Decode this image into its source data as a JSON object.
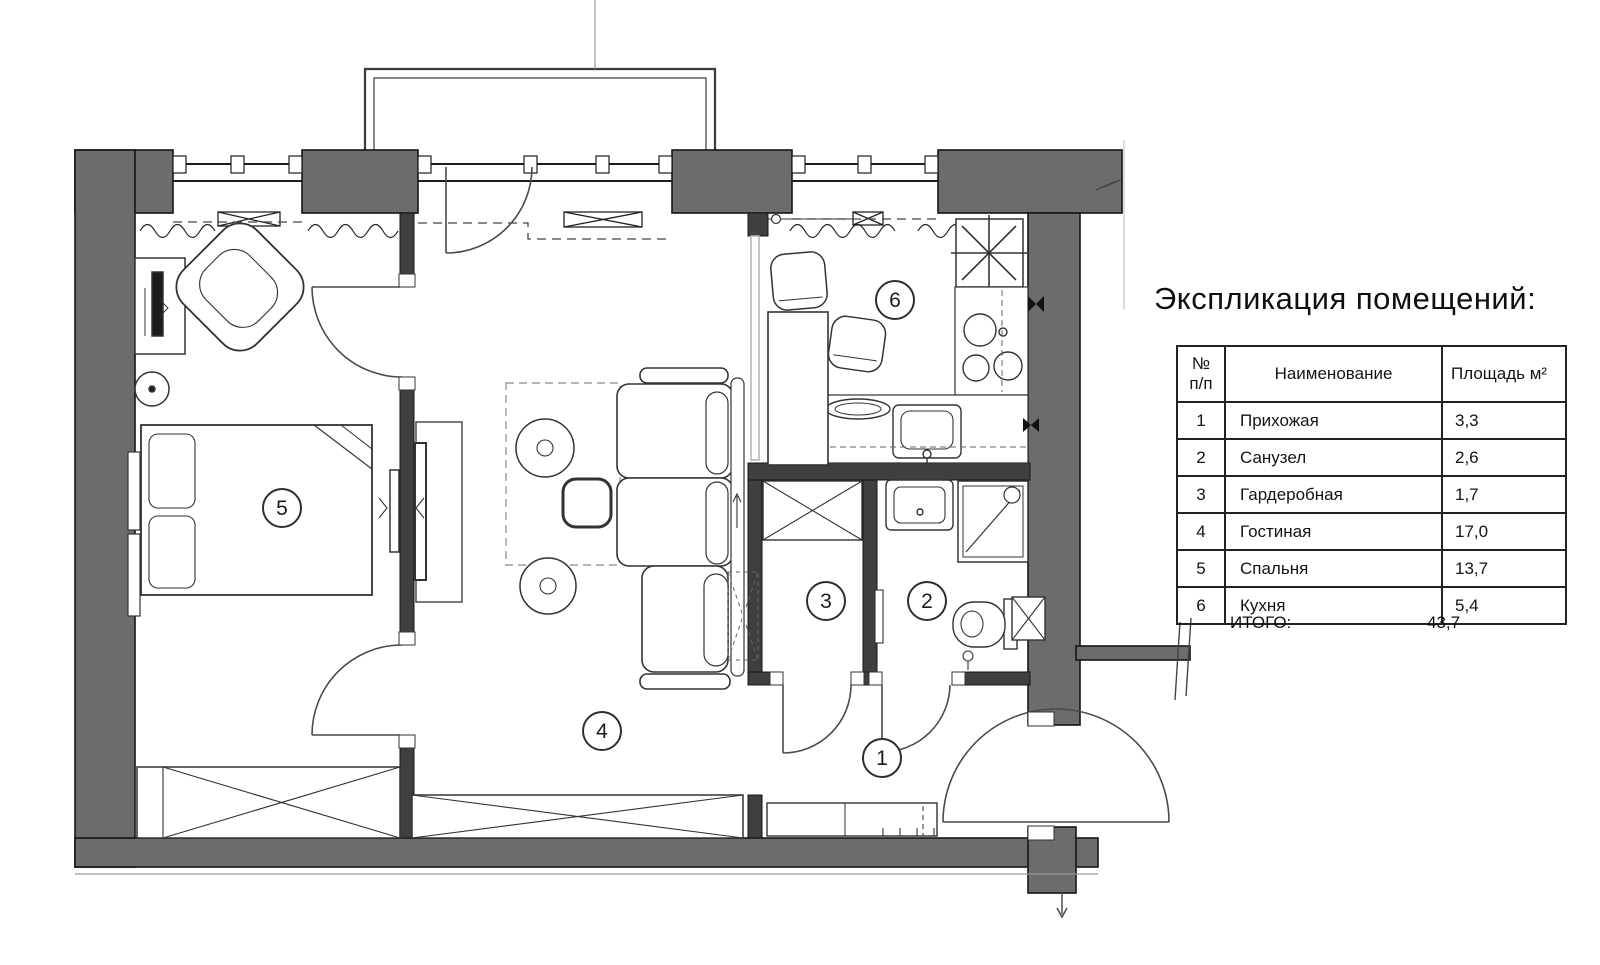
{
  "title": "Экспликация помещений:",
  "table": {
    "header": {
      "num_line1": "№",
      "num_line2": "п/п",
      "name": "Наименование",
      "area": "Площадь м²"
    },
    "rows": [
      {
        "num": "1",
        "name": "Прихожая",
        "area": "3,3"
      },
      {
        "num": "2",
        "name": "Санузел",
        "area": "2,6"
      },
      {
        "num": "3",
        "name": "Гардеробная",
        "area": "1,7"
      },
      {
        "num": "4",
        "name": "Гостиная",
        "area": "17,0"
      },
      {
        "num": "5",
        "name": "Спальня",
        "area": "13,7"
      },
      {
        "num": "6",
        "name": "Кухня",
        "area": "5,4"
      }
    ],
    "total": {
      "label": "ИТОГО:",
      "value": "43,7"
    }
  },
  "plan": {
    "room_labels": [
      "1",
      "2",
      "3",
      "4",
      "5",
      "6"
    ],
    "colors": {
      "wall_exterior": "#6c6c6c",
      "wall_interior": "#3f3f3f",
      "line": "#2a2a2a"
    }
  }
}
